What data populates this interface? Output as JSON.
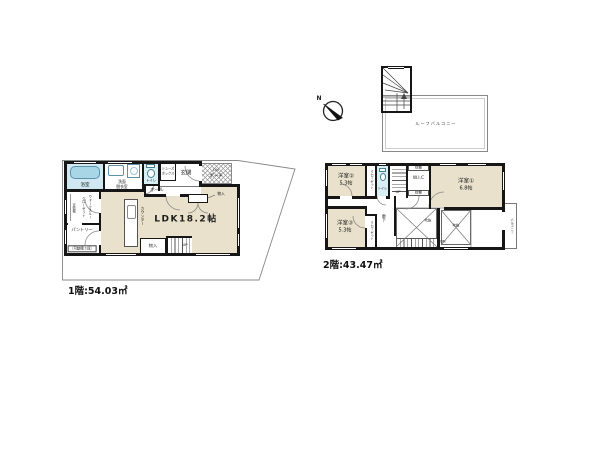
{
  "colors": {
    "room_fill": "#e9e1cb",
    "wet_fill": "#cfe8f1",
    "wall": "#161616",
    "hatch_line": "#9a9a9a"
  },
  "compass": {
    "north": "N"
  },
  "roof": {
    "balcony": "ルーフバルコニー"
  },
  "floor1": {
    "caption": "1階:54.03㎡",
    "bath": "浴室",
    "washroom1": "洗面",
    "washroom2": "脱衣室",
    "toilet": "トイレ",
    "shoes1": "シューズ",
    "shoes2": "ボックス",
    "hall": "ホール",
    "entrance": "玄関",
    "porch_dn": "DN",
    "porch": "ポーチ",
    "ldk": "LDK18.2帖",
    "ldk_closet": "物入",
    "counter": "カウンター",
    "storage": "物入",
    "up": "UP",
    "pantry": "パントリー",
    "pantry_note": "（可動棚３段）",
    "closet1": "ウォークスルー",
    "closet2": "クローゼット",
    "closet_shelf": "可動棚"
  },
  "floor2": {
    "caption": "2階:43.47㎡",
    "room1": "洋室①",
    "room1_size": "6.8帖",
    "room2": "洋室②",
    "room2_size": "5.3帖",
    "room3": "洋室③",
    "room3_size": "5.3帖",
    "closet_a": "クローゼット",
    "closet_b": "クローゼット",
    "toilet": "トイレ",
    "wic": "W.I.C",
    "shelf_top": "枕棚",
    "shelf_bottom": "枕棚",
    "hallway": "廊下",
    "up": "UP",
    "dn": "DN",
    "void_a": "吹抜",
    "void_b": "吹抜",
    "balcony": "バルコニー"
  }
}
